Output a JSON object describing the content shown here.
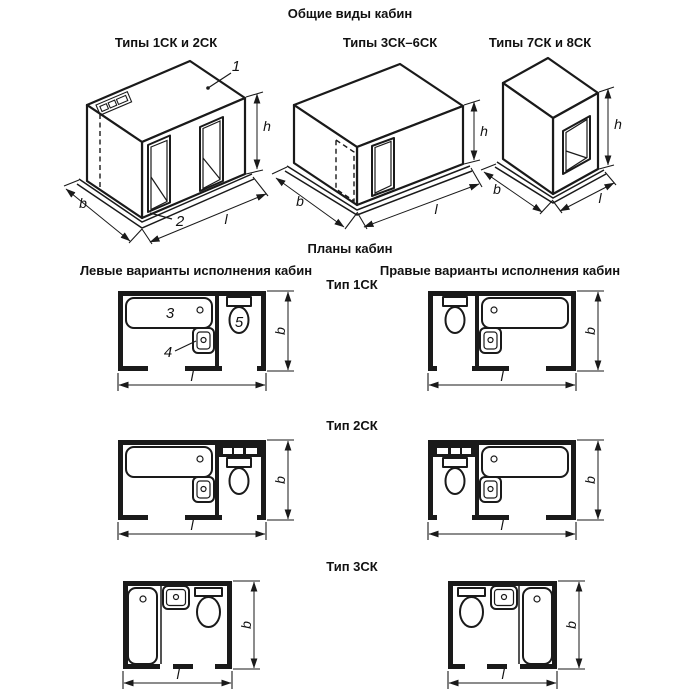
{
  "page": {
    "background": "#ffffff",
    "ink": "#1a1a1a"
  },
  "general_views": {
    "title": "Общие виды кабин",
    "cabins": [
      {
        "label": "Типы 1СК и 2СК",
        "callout_roof": "1",
        "callout_base": "2",
        "dim_b": "b",
        "dim_l": "l",
        "dim_h": "h"
      },
      {
        "label": "Типы 3СК–6СК",
        "dim_b": "b",
        "dim_l": "l",
        "dim_h": "h"
      },
      {
        "label": "Типы 7СК и 8СК",
        "dim_b": "b",
        "dim_l": "l",
        "dim_h": "h"
      }
    ]
  },
  "plans": {
    "title": "Планы кабин",
    "left_header": "Левые варианты исполнения кабин",
    "right_header": "Правые варианты исполнения кабин",
    "rows": [
      {
        "type_label": "Тип 1СК",
        "callout_bath": "3",
        "callout_sink": "4",
        "callout_toilet": "5",
        "left": {
          "dim_b": "b",
          "dim_l": "l"
        },
        "right": {
          "dim_b": "b",
          "dim_l": "l"
        }
      },
      {
        "type_label": "Тип 2СК",
        "left": {
          "dim_b": "b",
          "dim_l": "l"
        },
        "right": {
          "dim_b": "b",
          "dim_l": "l"
        }
      },
      {
        "type_label": "Тип 3СК",
        "left": {
          "dim_b": "b",
          "dim_l": "l"
        },
        "right": {
          "dim_b": "b",
          "dim_l": "l"
        }
      }
    ]
  }
}
